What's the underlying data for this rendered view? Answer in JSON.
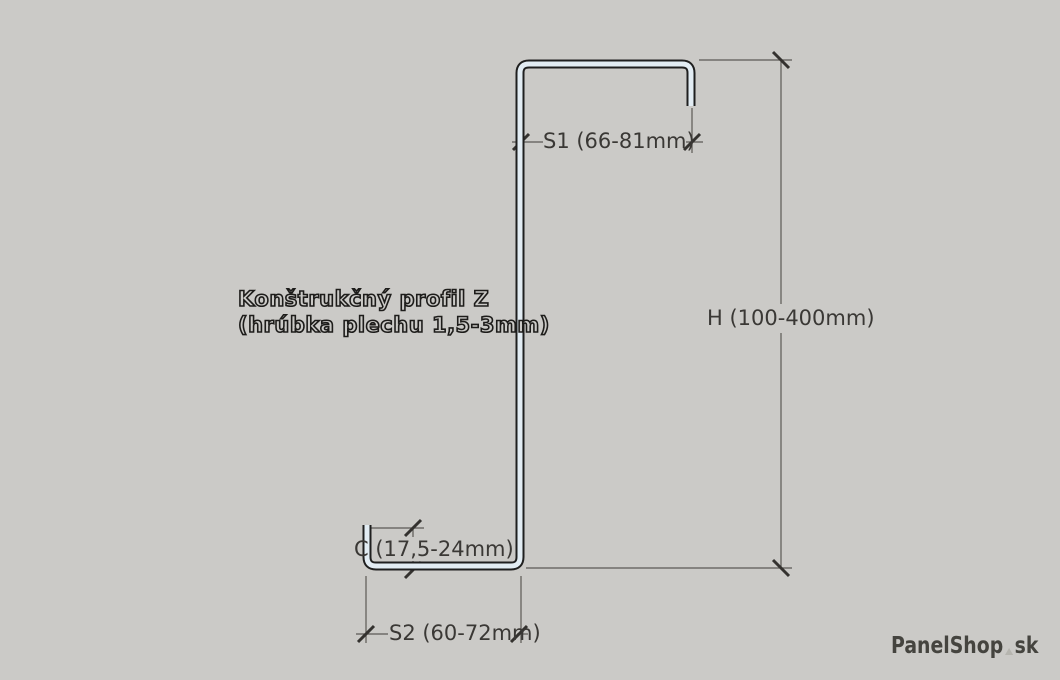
{
  "canvas": {
    "width": 1060,
    "height": 680,
    "background": "#cbcac7"
  },
  "title": {
    "line1": "Konštrukčný profil Z",
    "line2": "(hrúbka plechu 1,5-3mm)"
  },
  "dimensions": {
    "s1_label": "S1 (66-81mm)",
    "h_label": "H (100-400mm)",
    "c_label": "C (17,5-24mm)",
    "s2_label": "S2 (60-72mm)"
  },
  "watermark": {
    "brand": "PanelShop",
    "suffix": "sk"
  },
  "colors": {
    "background": "#cbcac7",
    "profile_outline": "#1f1f1f",
    "profile_sheet_fill": "#e2ecf3",
    "dimension_line": "#5b5955",
    "tick_mark": "#34322f",
    "label_text": "#3a3835",
    "title_outline": "#1d1c1a",
    "watermark_text": "#45443f",
    "watermark_droplet": "#b6b5af"
  }
}
